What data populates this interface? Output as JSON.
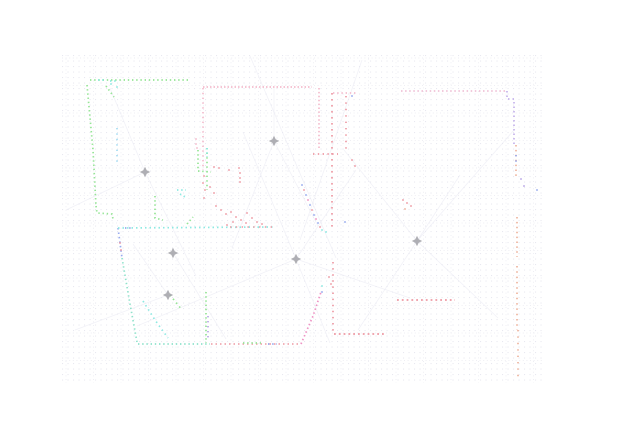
{
  "map": {
    "width": 634,
    "height": 435,
    "background": "#ffffff",
    "colors": {
      "green": "#95e595",
      "cyan": "#8de9e2",
      "lightblue": "#a5dcf2",
      "blue": "#96a9ee",
      "pink": "#f4bccd",
      "pinklav": "#f0c2d8",
      "rose": "#ee9aa4",
      "softred": "#f0a8b0",
      "magenta": "#ee93c4",
      "lavender": "#c5b3ec",
      "peach": "#eeb49e",
      "teal": "#8fe2cb",
      "purple": "#b9a6e6",
      "ray": "#e9e9f3"
    },
    "grid": {
      "x0": 62,
      "y0": 55,
      "x1": 543,
      "y1": 383,
      "spacing": 5.5,
      "dot_color": "#e8e8f0",
      "major_every": 27.5,
      "major_color": "#e3e3ec"
    },
    "rays": [
      [
        [
          274,
          141
        ],
        [
          232,
          248
        ]
      ],
      [
        [
          274,
          141
        ],
        [
          318,
          226
        ]
      ],
      [
        [
          274,
          141
        ],
        [
          274,
          87
        ]
      ],
      [
        [
          296,
          259
        ],
        [
          243,
          132
        ]
      ],
      [
        [
          296,
          259
        ],
        [
          356,
          170
        ]
      ],
      [
        [
          296,
          259
        ],
        [
          410,
          298
        ]
      ],
      [
        [
          296,
          259
        ],
        [
          330,
          343
        ]
      ],
      [
        [
          296,
          259
        ],
        [
          137,
          326
        ]
      ],
      [
        [
          417,
          241
        ],
        [
          344,
          150
        ]
      ],
      [
        [
          417,
          241
        ],
        [
          498,
          318
        ]
      ],
      [
        [
          417,
          241
        ],
        [
          460,
          175
        ]
      ],
      [
        [
          417,
          241
        ],
        [
          358,
          330
        ]
      ],
      [
        [
          417,
          241
        ],
        [
          514,
          130
        ]
      ],
      [
        [
          145,
          172
        ],
        [
          110,
          88
        ]
      ],
      [
        [
          145,
          172
        ],
        [
          196,
          276
        ]
      ],
      [
        [
          145,
          172
        ],
        [
          66,
          210
        ]
      ],
      [
        [
          173,
          253
        ],
        [
          226,
          339
        ]
      ],
      [
        [
          168,
          295
        ],
        [
          133,
          244
        ]
      ],
      [
        [
          168,
          295
        ],
        [
          75,
          330
        ]
      ],
      [
        [
          250,
          56
        ],
        [
          336,
          258
        ]
      ],
      [
        [
          362,
          60
        ],
        [
          300,
          240
        ]
      ]
    ],
    "walls": [
      {
        "name": "tl-top",
        "color": "green",
        "points": [
          [
            90,
            80
          ],
          [
            190,
            80
          ]
        ]
      },
      {
        "name": "tl-top-cyan-a",
        "color": "cyan",
        "points": [
          [
            98,
            80
          ],
          [
            105,
            80
          ]
        ]
      },
      {
        "name": "tl-top-cyan-b",
        "color": "cyan",
        "points": [
          [
            110,
            81
          ],
          [
            117,
            81
          ]
        ]
      },
      {
        "name": "tl-left",
        "color": "green",
        "points": [
          [
            87,
            85
          ],
          [
            93,
            150
          ],
          [
            96,
            206
          ]
        ]
      },
      {
        "name": "tl-left-step",
        "color": "green",
        "points": [
          [
            96,
            206
          ],
          [
            97,
            213
          ],
          [
            112,
            214
          ],
          [
            113,
            219
          ]
        ]
      },
      {
        "name": "tl-inner-diag",
        "color": "green",
        "points": [
          [
            106,
            86
          ],
          [
            114,
            97
          ]
        ]
      },
      {
        "name": "tl-blue-vert",
        "color": "lightblue",
        "points": [
          [
            117,
            128
          ],
          [
            117,
            162
          ]
        ],
        "dash": "1.4 4"
      },
      {
        "name": "tl-right-vert",
        "color": "green",
        "points": [
          [
            198,
            150
          ],
          [
            198,
            171
          ],
          [
            211,
            172
          ]
        ]
      },
      {
        "name": "tl-zigzag",
        "color": "green",
        "points": [
          [
            155,
            196
          ],
          [
            155,
            218
          ],
          [
            163,
            220
          ]
        ]
      },
      {
        "name": "tl-cyan-patch",
        "color": "cyan",
        "points": [
          [
            177,
            190
          ],
          [
            186,
            190
          ]
        ]
      },
      {
        "name": "tl-cyan-patch2",
        "color": "cyan",
        "points": [
          [
            180,
            194
          ],
          [
            185,
            197
          ]
        ]
      },
      {
        "name": "tm-top",
        "color": "pink",
        "points": [
          [
            203,
            87
          ],
          [
            312,
            87
          ]
        ],
        "dash": "1.5 2"
      },
      {
        "name": "tm-left",
        "color": "pink",
        "points": [
          [
            203,
            88
          ],
          [
            203,
            170
          ]
        ],
        "dash": "1.4 3.4"
      },
      {
        "name": "tm-right",
        "color": "pink",
        "points": [
          [
            319,
            88
          ],
          [
            319,
            148
          ]
        ],
        "dash": "1.5 2.4"
      },
      {
        "name": "tm-lintel",
        "color": "rose",
        "points": [
          [
            313,
            154
          ],
          [
            338,
            154
          ]
        ],
        "dash": "1.4 3.4"
      },
      {
        "name": "tm-inner-vert",
        "color": "rose",
        "points": [
          [
            332,
            93
          ],
          [
            332,
            228
          ]
        ],
        "dash": "1.6 4.4"
      },
      {
        "name": "tr-top-a",
        "color": "pink",
        "points": [
          [
            333,
            93
          ],
          [
            356,
            93
          ]
        ]
      },
      {
        "name": "tr-inner-vert",
        "color": "rose",
        "points": [
          [
            346,
            96
          ],
          [
            346,
            150
          ]
        ],
        "dash": "1.4 5"
      },
      {
        "name": "tr-top",
        "color": "pinklav",
        "points": [
          [
            401,
            91
          ],
          [
            507,
            91
          ]
        ],
        "dash": "1.5 2.6"
      },
      {
        "name": "tr-corner",
        "color": "lavender",
        "points": [
          [
            507,
            91
          ],
          [
            507,
            99
          ],
          [
            514,
            99
          ],
          [
            514,
            144
          ]
        ],
        "dash": "1.5 3"
      },
      {
        "name": "r-wall-1",
        "color": "peach",
        "points": [
          [
            516,
            145
          ],
          [
            516,
            177
          ]
        ],
        "dash": "1.5 3.4"
      },
      {
        "name": "r-wall-1b",
        "color": "blue",
        "points": [
          [
            516,
            155
          ],
          [
            516,
            164
          ]
        ],
        "dash": "1.4 4"
      },
      {
        "name": "r-wall-2",
        "color": "peach",
        "points": [
          [
            517,
            217
          ],
          [
            517,
            257
          ]
        ],
        "dash": "1.5 3.4"
      },
      {
        "name": "r-wall-3",
        "color": "peach",
        "points": [
          [
            517,
            266
          ],
          [
            517,
            330
          ]
        ],
        "dash": "1.5 3.8"
      },
      {
        "name": "r-wall-4",
        "color": "peach",
        "points": [
          [
            518,
            330
          ],
          [
            518,
            377
          ]
        ],
        "dash": "1.4 5"
      },
      {
        "name": "br-horiz-1",
        "color": "rose",
        "points": [
          [
            397,
            300
          ],
          [
            455,
            300
          ]
        ],
        "dash": "1.8 3"
      },
      {
        "name": "br-horiz-2",
        "color": "rose",
        "points": [
          [
            334,
            334
          ],
          [
            384,
            334
          ]
        ],
        "dash": "1.8 3"
      },
      {
        "name": "br-vert",
        "color": "rose",
        "points": [
          [
            333,
            262
          ],
          [
            333,
            334
          ]
        ],
        "dash": "1.5 4.6"
      },
      {
        "name": "bl-left-upper",
        "color": "blue",
        "points": [
          [
            118,
            228
          ],
          [
            122,
            258
          ]
        ],
        "dash": "1.5 3"
      },
      {
        "name": "bl-left-lower",
        "color": "teal",
        "points": [
          [
            122,
            258
          ],
          [
            130,
            304
          ],
          [
            137,
            342
          ]
        ]
      },
      {
        "name": "bl-bottom-a",
        "color": "teal",
        "points": [
          [
            138,
            344
          ],
          [
            210,
            344
          ]
        ]
      },
      {
        "name": "bl-bottom-b",
        "color": "softred",
        "points": [
          [
            211,
            344
          ],
          [
            301,
            344
          ]
        ],
        "dash": "1.5 3"
      },
      {
        "name": "bl-bottom-green",
        "color": "green",
        "points": [
          [
            243,
            343
          ],
          [
            261,
            343
          ]
        ]
      },
      {
        "name": "bl-bottom-blue",
        "color": "blue",
        "points": [
          [
            268,
            344
          ],
          [
            277,
            344
          ]
        ]
      },
      {
        "name": "bl-diag",
        "color": "magenta",
        "points": [
          [
            301,
            344
          ],
          [
            313,
            316
          ],
          [
            321,
            292
          ]
        ],
        "dash": "1.5 2.6"
      },
      {
        "name": "bl-right",
        "color": "green",
        "points": [
          [
            206,
            292
          ],
          [
            206,
            343
          ]
        ]
      },
      {
        "name": "bl-right-purple",
        "color": "purple",
        "points": [
          [
            208,
            316
          ],
          [
            208,
            341
          ]
        ],
        "dash": "1.4 3.6"
      },
      {
        "name": "bl-cyan-diag",
        "color": "cyan",
        "points": [
          [
            143,
            301
          ],
          [
            155,
            320
          ],
          [
            168,
            338
          ]
        ],
        "dash": "1.5 3.4"
      },
      {
        "name": "bl-green-diag",
        "color": "green",
        "points": [
          [
            170,
            295
          ],
          [
            182,
            310
          ]
        ],
        "dash": "1.5 3.4"
      },
      {
        "name": "mid-vert",
        "color": "green",
        "points": [
          [
            207,
            148
          ],
          [
            207,
            190
          ]
        ],
        "dash": "1.4 3.2"
      },
      {
        "name": "mid-vert-cyan",
        "color": "cyan",
        "points": [
          [
            207,
            148
          ],
          [
            207,
            157
          ]
        ]
      },
      {
        "name": "corridor",
        "color": "cyan",
        "points": [
          [
            118,
            228
          ],
          [
            273,
            227
          ]
        ],
        "dash": "1.5 3"
      },
      {
        "name": "corridor-blue",
        "color": "blue",
        "points": [
          [
            125,
            228
          ],
          [
            133,
            228
          ]
        ]
      },
      {
        "name": "corridor-rose",
        "color": "softred",
        "points": [
          [
            230,
            227
          ],
          [
            273,
            227
          ]
        ],
        "dash": "1.4 4.4"
      },
      {
        "name": "corridor-green",
        "color": "green",
        "points": [
          [
            187,
            224
          ],
          [
            193,
            217
          ]
        ]
      }
    ],
    "clutter": [
      [
        196,
        139,
        "pink"
      ],
      [
        196,
        144,
        "pink"
      ],
      [
        197,
        148,
        "pink"
      ],
      [
        204,
        176,
        "rose"
      ],
      [
        203,
        183,
        "rose"
      ],
      [
        205,
        190,
        "rose"
      ],
      [
        210,
        187,
        "rose"
      ],
      [
        214,
        193,
        "rose"
      ],
      [
        204,
        198,
        "rose"
      ],
      [
        214,
        167,
        "rose"
      ],
      [
        219,
        168,
        "rose"
      ],
      [
        229,
        170,
        "rose"
      ],
      [
        239,
        168,
        "rose"
      ],
      [
        240,
        173,
        "rose"
      ],
      [
        240,
        178,
        "rose"
      ],
      [
        240,
        182,
        "rose"
      ],
      [
        216,
        206,
        "rose"
      ],
      [
        221,
        210,
        "rose"
      ],
      [
        226,
        214,
        "rose"
      ],
      [
        231,
        212,
        "rose"
      ],
      [
        236,
        217,
        "rose"
      ],
      [
        241,
        220,
        "rose"
      ],
      [
        246,
        223,
        "rose"
      ],
      [
        252,
        218,
        "rose"
      ],
      [
        257,
        222,
        "rose"
      ],
      [
        262,
        224,
        "rose"
      ],
      [
        247,
        213,
        "rose"
      ],
      [
        233,
        222,
        "rose"
      ],
      [
        227,
        225,
        "rose"
      ],
      [
        352,
        160,
        "rose"
      ],
      [
        355,
        166,
        "rose"
      ],
      [
        403,
        200,
        "rose"
      ],
      [
        407,
        203,
        "rose"
      ],
      [
        411,
        206,
        "rose"
      ],
      [
        405,
        209,
        "peach"
      ],
      [
        329,
        277,
        "rose"
      ],
      [
        331,
        284,
        "rose"
      ],
      [
        120,
        243,
        "rose"
      ],
      [
        121,
        250,
        "rose"
      ],
      [
        302,
        185,
        "blue"
      ],
      [
        304,
        190,
        "rose"
      ],
      [
        306,
        195,
        "blue"
      ],
      [
        308,
        200,
        "magenta"
      ],
      [
        310,
        205,
        "blue"
      ],
      [
        312,
        210,
        "rose"
      ],
      [
        314,
        215,
        "blue"
      ],
      [
        316,
        219,
        "magenta"
      ],
      [
        318,
        223,
        "blue"
      ],
      [
        320,
        227,
        "rose"
      ],
      [
        322,
        230,
        "cyan"
      ],
      [
        326,
        232,
        "cyan"
      ],
      [
        322,
        286,
        "cyan"
      ],
      [
        322,
        292,
        "blue"
      ],
      [
        345,
        222,
        "blue"
      ],
      [
        537,
        190,
        "blue"
      ],
      [
        352,
        96,
        "blue"
      ],
      [
        117,
        87,
        "cyan"
      ],
      [
        111,
        84,
        "cyan"
      ],
      [
        521,
        179,
        "purple"
      ],
      [
        524,
        186,
        "purple"
      ]
    ],
    "markers": [
      [
        274,
        141
      ],
      [
        145,
        172
      ],
      [
        173,
        253
      ],
      [
        296,
        259
      ],
      [
        417,
        241
      ],
      [
        168,
        295
      ]
    ],
    "marker": {
      "color": "#a6a6ac",
      "path": "M0 -5.2 L1.7 -1.7 L5.2 0 L1.7 1.7 L0 5.2 L-1.7 1.7 L-5.2 0 L-1.7 -1.7 Z"
    }
  }
}
